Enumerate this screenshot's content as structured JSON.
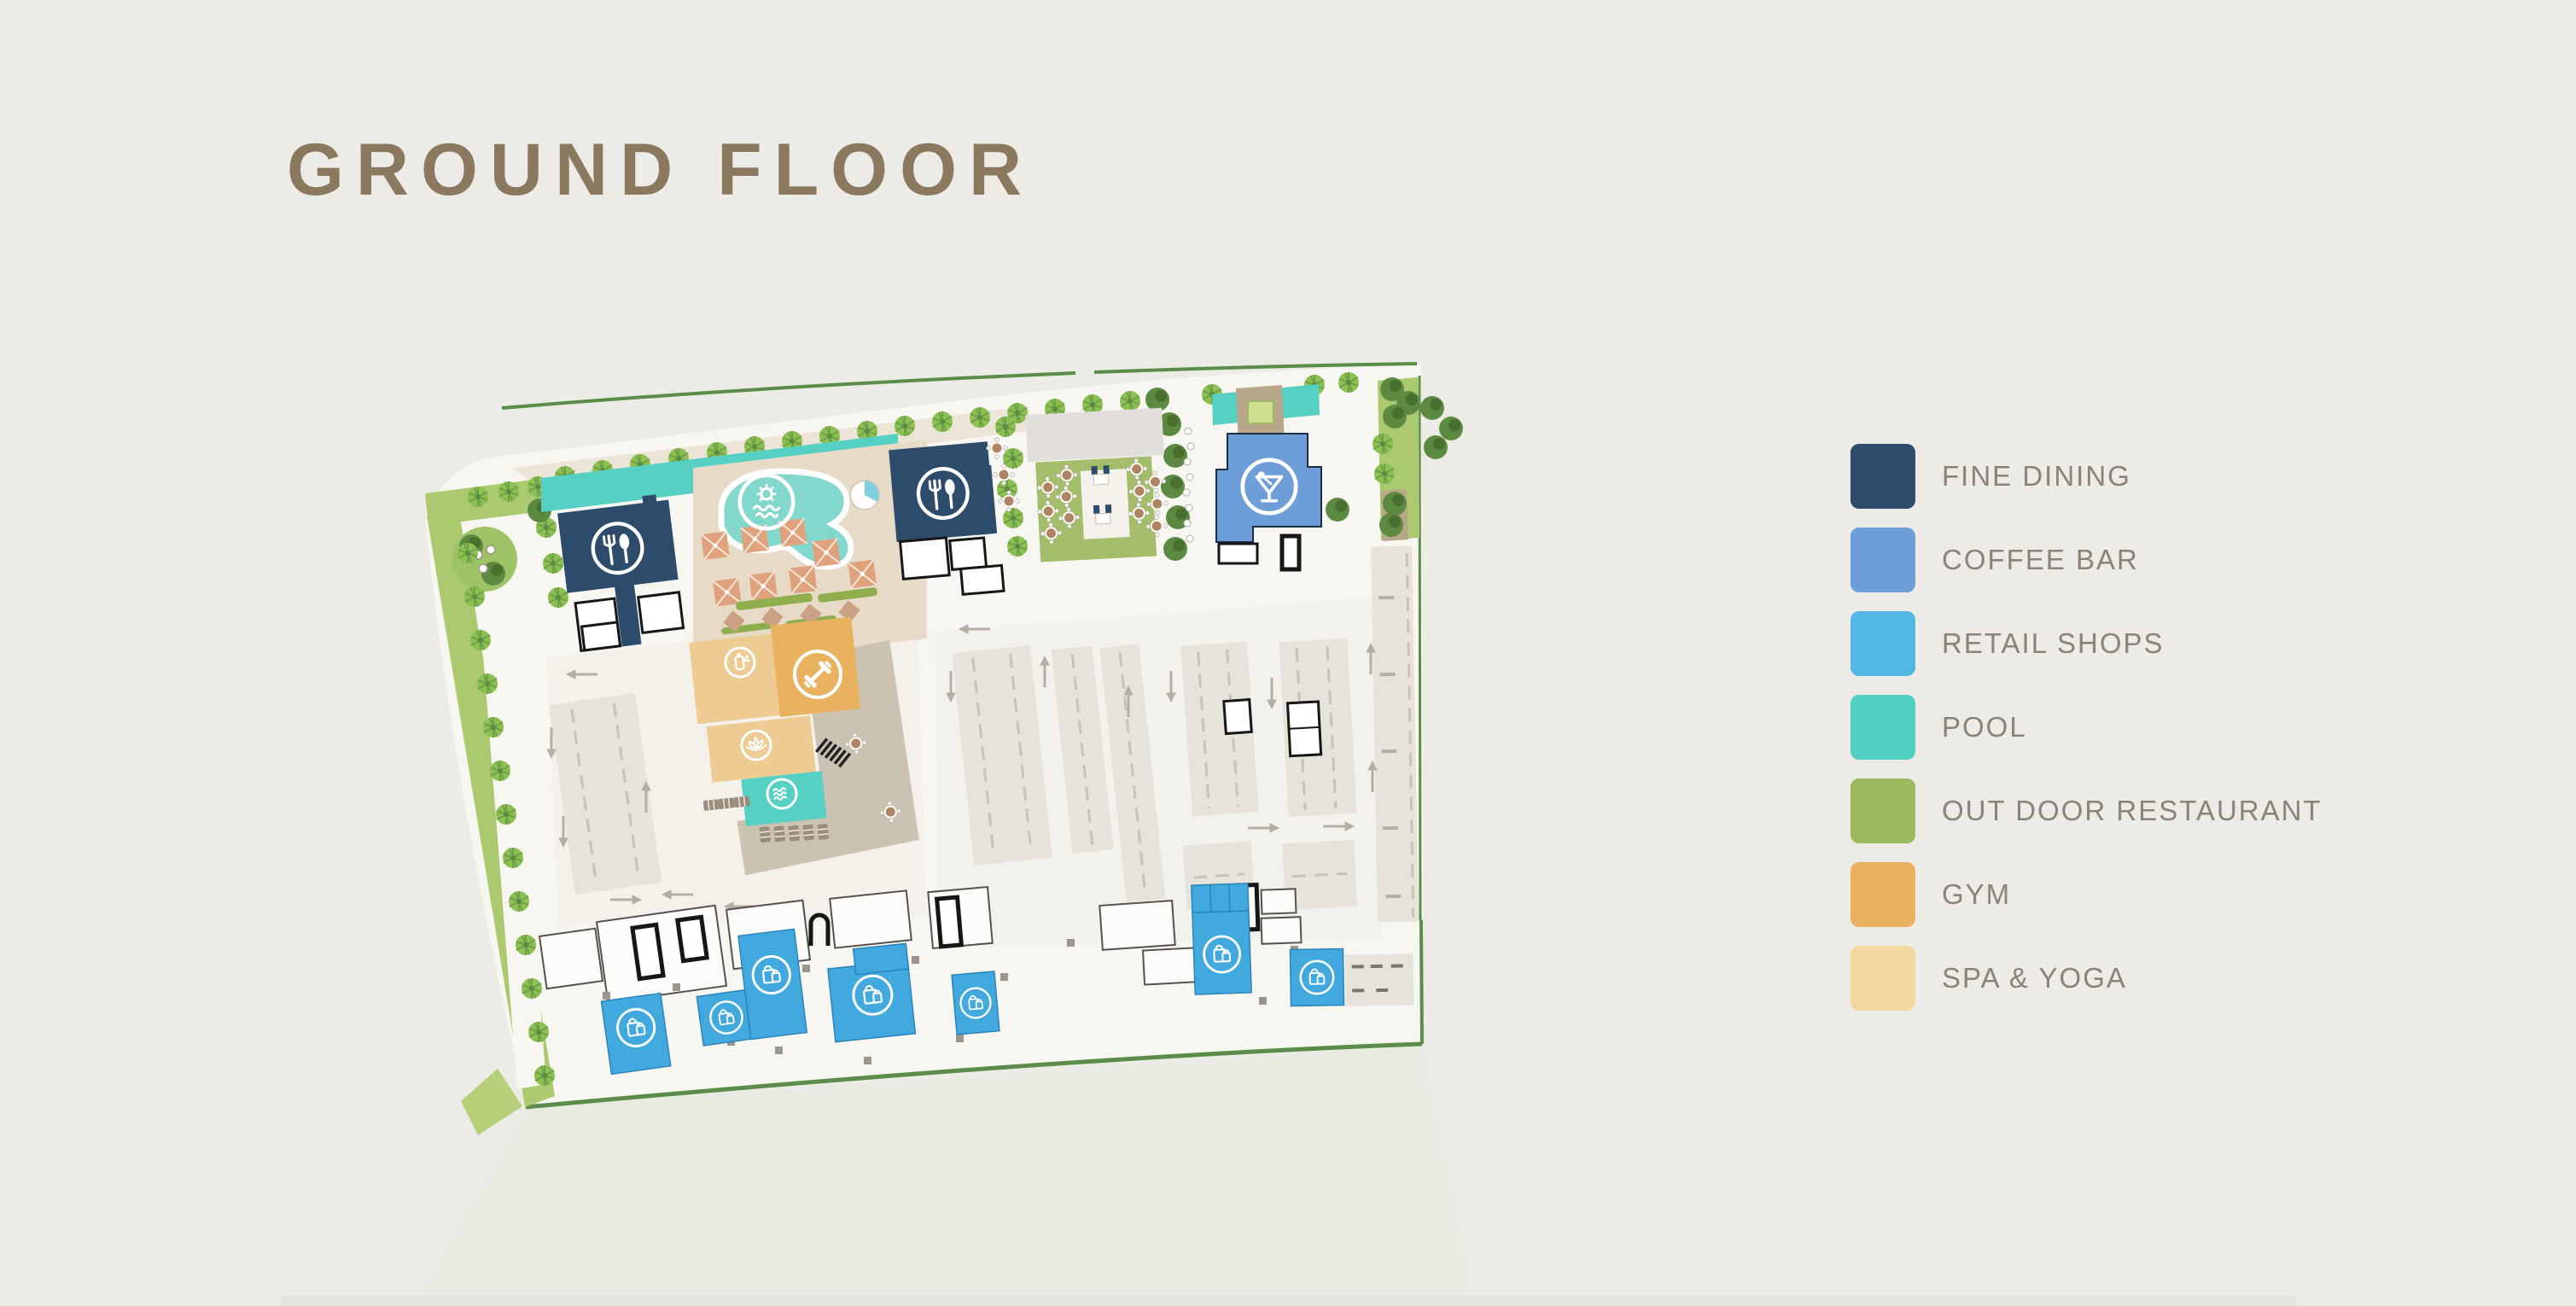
{
  "page": {
    "title": "GROUND FLOOR"
  },
  "legend": {
    "items": [
      {
        "label": "FINE DINING",
        "color": "#2d4c6b"
      },
      {
        "label": "COFFEE BAR",
        "color": "#6d9ed8"
      },
      {
        "label": "RETAIL SHOPS",
        "color": "#52b7e4"
      },
      {
        "label": "POOL",
        "color": "#4fd0c2"
      },
      {
        "label": "OUT DOOR RESTAURANT",
        "color": "#9cba5d"
      },
      {
        "label": "GYM",
        "color": "#e9b263"
      },
      {
        "label": "SPA & YOGA",
        "color": "#f3d89f"
      }
    ]
  },
  "plan": {
    "areas": [
      {
        "name": "fine-dining-west",
        "category": "FINE DINING",
        "icon": "fork-spoon-icon"
      },
      {
        "name": "fine-dining-central",
        "category": "FINE DINING",
        "icon": "fork-spoon-icon"
      },
      {
        "name": "coffee-bar",
        "category": "COFFEE BAR",
        "icon": "cocktail-icon"
      },
      {
        "name": "outdoor-restaurant",
        "category": "OUT DOOR RESTAURANT",
        "icon": null
      },
      {
        "name": "main-pool",
        "category": "POOL",
        "icon": "sun-waves-icon"
      },
      {
        "name": "indoor-pool",
        "category": "POOL",
        "icon": "waves-icon"
      },
      {
        "name": "gym",
        "category": "GYM",
        "icon": "dumbbell-icon"
      },
      {
        "name": "spa",
        "category": "SPA & YOGA",
        "icon": "aroma-candle-icon"
      },
      {
        "name": "yoga",
        "category": "SPA & YOGA",
        "icon": "lotus-icon"
      },
      {
        "name": "retail-shop-1",
        "category": "RETAIL SHOPS",
        "icon": "shopping-bag-icon"
      },
      {
        "name": "retail-shop-2",
        "category": "RETAIL SHOPS",
        "icon": "shopping-bag-icon"
      },
      {
        "name": "retail-shop-3",
        "category": "RETAIL SHOPS",
        "icon": "shopping-bag-icon"
      },
      {
        "name": "retail-shop-4",
        "category": "RETAIL SHOPS",
        "icon": "shopping-bag-icon"
      },
      {
        "name": "retail-shop-5",
        "category": "RETAIL SHOPS",
        "icon": "shopping-bag-icon"
      },
      {
        "name": "retail-shop-6",
        "category": "RETAIL SHOPS",
        "icon": "shopping-bag-icon"
      },
      {
        "name": "retail-shop-7",
        "category": "RETAIL SHOPS",
        "icon": "shopping-bag-icon"
      }
    ]
  },
  "colors": {
    "page_bg": "#ecebe6",
    "title_color": "#8a795e",
    "legend_text": "#8b8377",
    "site_fill": "#f8f6f1",
    "fine_dining": "#2d4c6b",
    "coffee_bar": "#6d9ed8",
    "retail": "#41a9de",
    "pool": "#55d0c2",
    "pool_light": "#82d8cc",
    "patio_green": "#a3bd6b",
    "gym": "#e8b25e",
    "spa": "#eecb92",
    "landscape_green": "#abc96e",
    "palm_green": "#8cc050",
    "tree_dark": "#5d8a41",
    "boundary_green": "#5a8c4a",
    "parking_fill": "#e6e3da",
    "deck_tan": "#e7dbc8",
    "terrace": "#ccc2b2",
    "umbrella": "#dfa27c",
    "walk_brown": "#b9a78c",
    "icon_white": "#ffffff",
    "arrow_gray": "#b4afa4"
  }
}
